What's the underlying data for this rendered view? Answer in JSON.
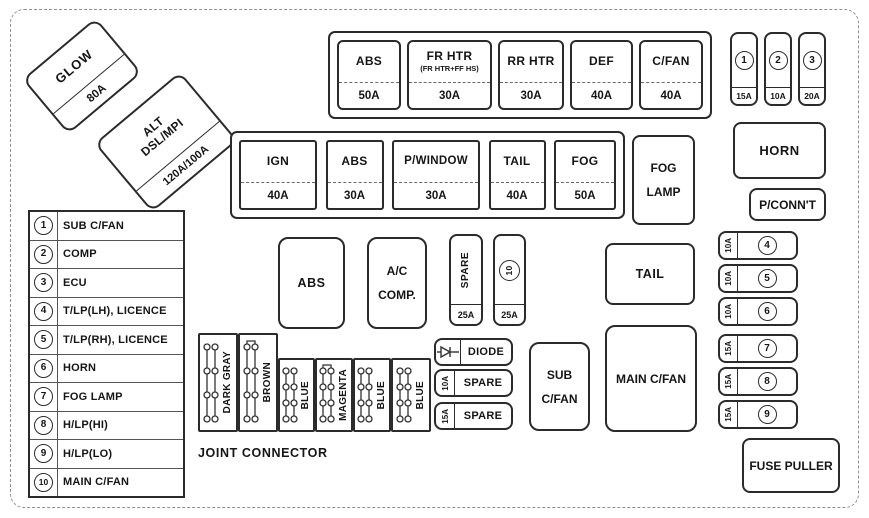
{
  "relays": {
    "glow": {
      "label": "GLOW",
      "amp": "80A"
    },
    "alt": {
      "line1": "ALT",
      "line2": "DSL/MPI",
      "amp": "120A/100A"
    },
    "fog_lamp": {
      "line1": "FOG",
      "line2": "LAMP"
    },
    "horn": {
      "label": "HORN"
    },
    "pconnt": {
      "label": "P/CONN'T"
    },
    "abs": {
      "label": "ABS"
    },
    "ac_comp": {
      "line1": "A/C",
      "line2": "COMP."
    },
    "tail": {
      "label": "TAIL"
    },
    "sub_cfan": {
      "line1": "SUB",
      "line2": "C/FAN"
    },
    "main_cfan": {
      "label": "MAIN C/FAN"
    },
    "fuse_puller": {
      "label": "FUSE PULLER"
    }
  },
  "top_bank": {
    "fuses": [
      {
        "label": "ABS",
        "amp": "50A"
      },
      {
        "label": "FR HTR",
        "sub": "(FR HTR+FF HS)",
        "amp": "30A"
      },
      {
        "label": "RR HTR",
        "amp": "30A"
      },
      {
        "label": "DEF",
        "amp": "40A"
      },
      {
        "label": "C/FAN",
        "amp": "40A"
      }
    ]
  },
  "mini_fuses": [
    {
      "num": "1",
      "amp": "15A"
    },
    {
      "num": "2",
      "amp": "10A"
    },
    {
      "num": "3",
      "amp": "20A"
    }
  ],
  "second_bank": {
    "fuses": [
      {
        "label": "IGN",
        "amp": "40A"
      },
      {
        "label": "ABS",
        "amp": "30A"
      },
      {
        "label": "P/WINDOW",
        "amp": "30A"
      },
      {
        "label": "TAIL",
        "amp": "40A"
      },
      {
        "label": "FOG",
        "amp": "50A"
      }
    ]
  },
  "spare_column": {
    "spare": {
      "label": "SPARE",
      "amp": "25A"
    },
    "fuse10": {
      "num": "10",
      "amp": "25A"
    }
  },
  "right_fuses": [
    {
      "amp": "10A",
      "num": "4"
    },
    {
      "amp": "10A",
      "num": "5"
    },
    {
      "amp": "10A",
      "num": "6"
    },
    {
      "amp": "15A",
      "num": "7"
    },
    {
      "amp": "15A",
      "num": "8"
    },
    {
      "amp": "15A",
      "num": "9"
    }
  ],
  "legend": {
    "items": [
      {
        "num": "1",
        "label": "SUB C/FAN"
      },
      {
        "num": "2",
        "label": "COMP"
      },
      {
        "num": "3",
        "label": "ECU"
      },
      {
        "num": "4",
        "label": "T/LP(LH), LICENCE"
      },
      {
        "num": "5",
        "label": "T/LP(RH), LICENCE"
      },
      {
        "num": "6",
        "label": "HORN"
      },
      {
        "num": "7",
        "label": "FOG LAMP"
      },
      {
        "num": "8",
        "label": "H/LP(HI)"
      },
      {
        "num": "9",
        "label": "H/LP(LO)"
      },
      {
        "num": "10",
        "label": "MAIN C/FAN"
      }
    ]
  },
  "joint_connector": {
    "title": "JOINT CONNECTOR",
    "blocks": [
      {
        "label": "DARK GRAY"
      },
      {
        "label": "BROWN"
      },
      {
        "label": "BLUE"
      },
      {
        "label": "MAGENTA"
      },
      {
        "label": "BLUE"
      },
      {
        "label": "BLUE"
      }
    ]
  },
  "small_boxes": {
    "diode": {
      "label": "DIODE"
    },
    "spare1": {
      "amp": "10A",
      "label": "SPARE"
    },
    "spare2": {
      "amp": "15A",
      "label": "SPARE"
    }
  }
}
